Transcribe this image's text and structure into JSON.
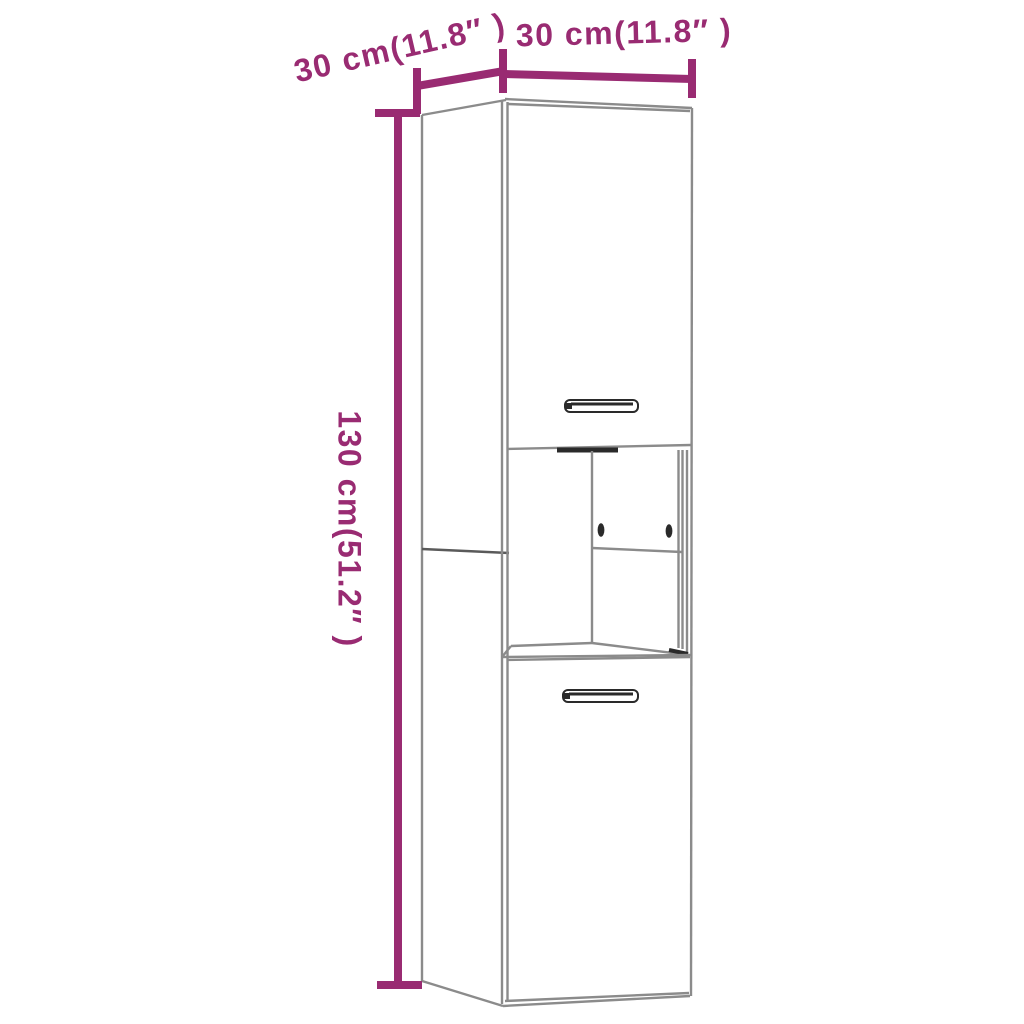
{
  "page": {
    "background": "#ffffff"
  },
  "colors": {
    "dimension": "#992b72",
    "outline": "#8b8b8b",
    "outline_mid": "#5a5a5a",
    "outline_dark": "#2a2a2a"
  },
  "diagram": {
    "type": "product-dimension-diagram",
    "subject": "tall two-door cabinet with open middle shelf",
    "labels": {
      "depth": "30 cm(11.8″ )",
      "width": "30 cm(11.8″ )",
      "height": "130 cm(51.2″ )"
    },
    "dimensions": {
      "width_cm": 30,
      "width_in": 11.8,
      "depth_cm": 30,
      "depth_in": 11.8,
      "height_cm": 130,
      "height_in": 51.2
    }
  }
}
